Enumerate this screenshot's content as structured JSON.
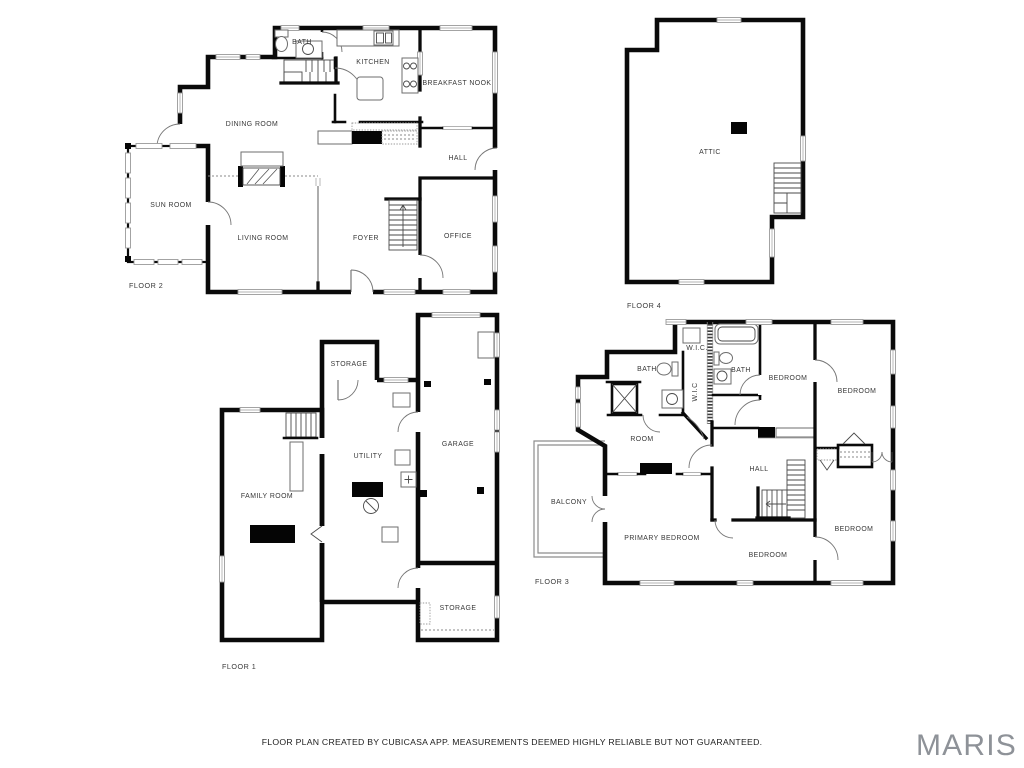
{
  "footer": {
    "disclaimer": "FLOOR PLAN CREATED BY CUBICASA APP. MEASUREMENTS DEEMED HIGHLY RELIABLE BUT NOT GUARANTEED."
  },
  "watermark": {
    "brand": "MARIS",
    "color": "#8e9298"
  },
  "palette": {
    "background": "#ffffff",
    "wall": "#0a0a0a",
    "label_text": "#383838",
    "window_stroke": "#9a9a9a",
    "door_arc": "#767676"
  },
  "floors": {
    "floor1": {
      "label": "FLOOR 1",
      "rooms": {
        "storage_top": "STORAGE",
        "utility": "UTILITY",
        "garage": "GARAGE",
        "family_room": "FAMILY ROOM",
        "storage_bottom": "STORAGE"
      }
    },
    "floor2": {
      "label": "FLOOR 2",
      "rooms": {
        "bath": "BATH",
        "kitchen": "KITCHEN",
        "breakfast_nook": "BREAKFAST NOOK",
        "dining_room": "DINING ROOM",
        "hall": "HALL",
        "sun_room": "SUN ROOM",
        "living_room": "LIVING ROOM",
        "foyer": "FOYER",
        "office": "OFFICE"
      }
    },
    "floor3": {
      "label": "FLOOR 3",
      "rooms": {
        "wic_top": "W.I.C.",
        "wic_closet": "W.I.C",
        "bath_left": "BATH",
        "bath_right": "BATH",
        "bedroom_top_mid": "BEDROOM",
        "bedroom_top_right": "BEDROOM",
        "room": "ROOM",
        "hall": "HALL",
        "balcony": "BALCONY",
        "primary_bedroom": "PRIMARY BEDROOM",
        "bedroom_bottom_mid": "BEDROOM",
        "bedroom_bottom_right": "BEDROOM"
      }
    },
    "floor4": {
      "label": "FLOOR 4",
      "rooms": {
        "attic": "ATTIC"
      }
    }
  }
}
